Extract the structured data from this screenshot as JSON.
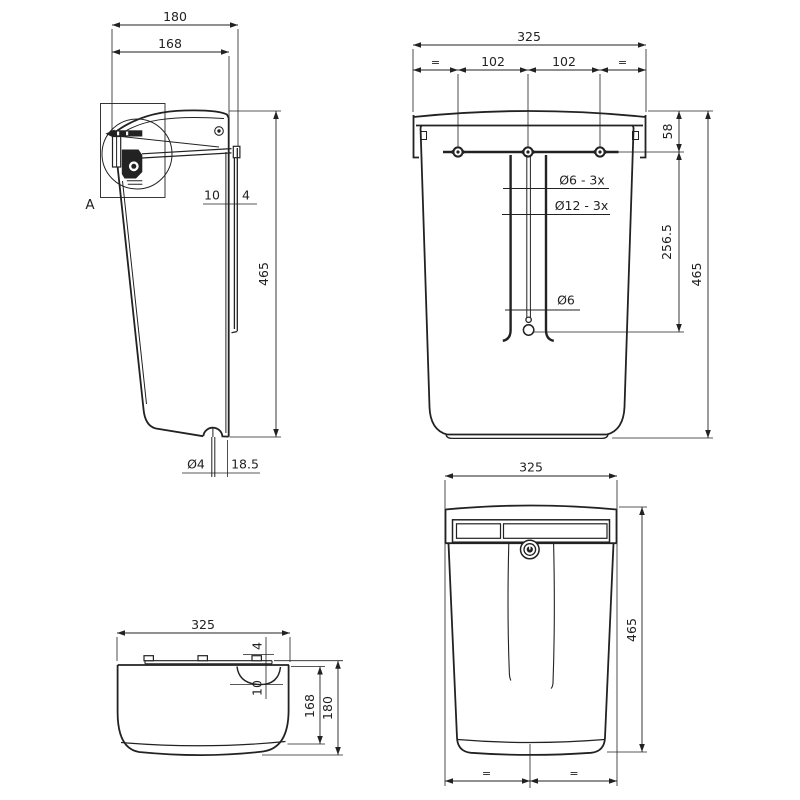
{
  "drawing": {
    "kind": "technical-drawing-mailbox",
    "line_color": "#222222",
    "background": "#ffffff",
    "views": {
      "side": {
        "name": "side-view",
        "detail_label": "A",
        "dims": {
          "overall_depth": "180",
          "body_depth": "168",
          "height": "465",
          "gap_back": "10",
          "gap_plate": "4",
          "drain_hole": "Ø4",
          "drain_offset": "18.5"
        }
      },
      "rear": {
        "name": "rear-view",
        "dims": {
          "width": "325",
          "equal_left": "=",
          "hole_spacing_left": "102",
          "hole_spacing_right": "102",
          "equal_right": "=",
          "top_offset": "58",
          "slot_length": "256.5",
          "height": "465",
          "hole_small": "Ø6 - 3x",
          "hole_large": "Ø12 - 3x",
          "keyhole": "Ø6"
        }
      },
      "front": {
        "name": "front-view",
        "dims": {
          "width": "325",
          "height": "465",
          "equal_left": "=",
          "equal_right": "="
        }
      },
      "top": {
        "name": "top-view",
        "dims": {
          "width": "325",
          "tab_height": "4",
          "recess_depth": "10",
          "body_depth": "168",
          "overall_depth": "180"
        }
      }
    }
  }
}
